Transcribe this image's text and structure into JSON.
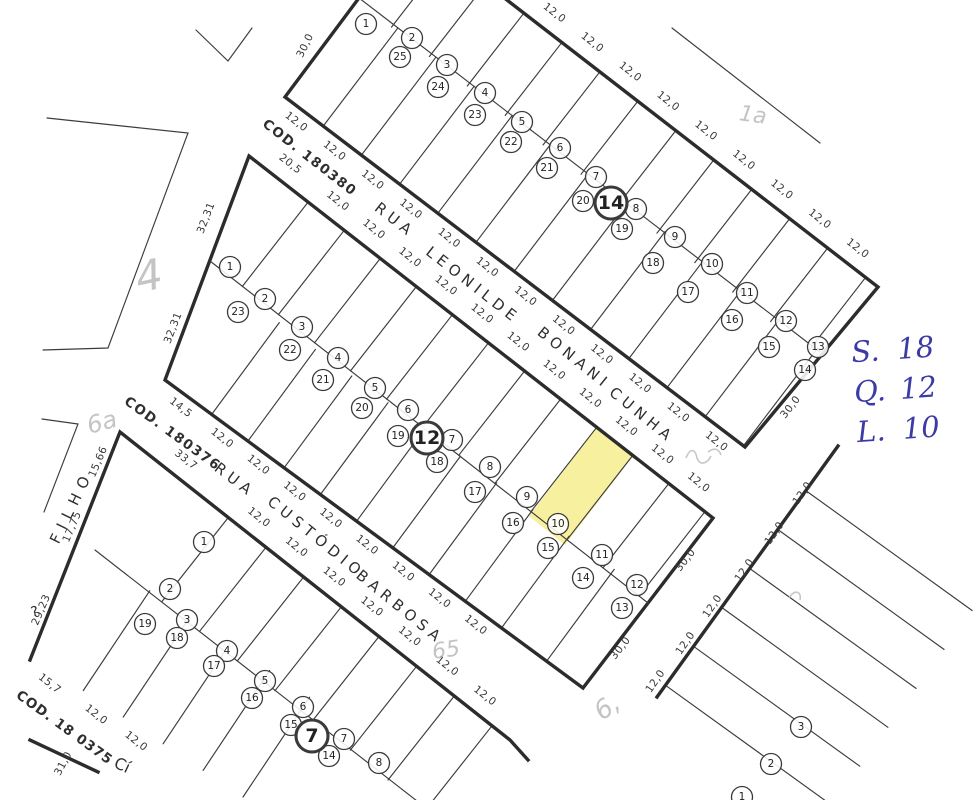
{
  "page": {
    "paper": "#ffffff",
    "ink": "#2c2c2c",
    "highlight_color": "#f6f09f",
    "pencil_color": "#b8b8b8",
    "handwriting_color": "#3c3aa5"
  },
  "annotation": {
    "lines": [
      {
        "label": "S.",
        "value": "18"
      },
      {
        "label": "Q.",
        "value": "12"
      },
      {
        "label": "L.",
        "value": "10"
      }
    ]
  },
  "highlight_info": {
    "quadra": "12",
    "lote": "10"
  },
  "map": {
    "highlight_lot": {
      "points": [
        [
          597,
          427
        ],
        [
          633,
          456
        ],
        [
          565,
          545
        ],
        [
          529,
          516
        ]
      ]
    },
    "rows": [
      {
        "id": "quadra14-front-leonilde",
        "edge": [
          285,
          97,
          745,
          447
        ],
        "side": 1,
        "depth": 123,
        "widths": [
          48,
          48,
          48,
          48,
          48,
          48,
          48,
          48,
          48,
          48,
          48,
          48
        ],
        "dims": [
          "12,0",
          "12,0",
          "12,0",
          "12,0",
          "12,0",
          "12,0",
          "12,0",
          "12,0",
          "12,0",
          "12,0",
          "12,0",
          "12,0"
        ],
        "dim_rot": 38
      },
      {
        "id": "quadra14-back-street",
        "edge": [
          410,
          -75,
          880,
          290
        ],
        "side": -1,
        "depth": 92,
        "widths": [
          48,
          48,
          48,
          48,
          48,
          48,
          48,
          48,
          48,
          48,
          48,
          48
        ],
        "dims": [
          "12,0",
          "12,0",
          "12,0",
          "12,0",
          "12,0",
          "12,0",
          "12,0",
          "12,0",
          "12,0",
          "12,0",
          "12,0",
          "12,0"
        ],
        "dim_rot": 38
      },
      {
        "id": "quadra12-front-leonilde",
        "edge": [
          249,
          156,
          713,
          518
        ],
        "side": -1,
        "depth": 107,
        "widths": [
          75,
          45.75,
          45.75,
          45.75,
          45.75,
          45.75,
          45.75,
          45.75,
          45.75,
          45.75,
          45.75,
          45.75,
          45.75
        ],
        "dims": [
          "20,5",
          "12,0",
          "12,0",
          "12,0",
          "12,0",
          "12,0",
          "12,0",
          "12,0",
          "12,0",
          "12,0",
          "12,0",
          "12,0",
          ""
        ],
        "dim_rot": 38
      },
      {
        "id": "quadra12-back-barbosa",
        "edge": [
          165,
          380,
          583,
          688
        ],
        "side": 1,
        "depth": 114,
        "widths": [
          58,
          45,
          45,
          45,
          45,
          45,
          45,
          45,
          45,
          56
        ],
        "dims": [
          "14,5",
          "12,0",
          "12,0",
          "12,0",
          "12,0",
          "12,0",
          "12,0",
          "12,0",
          "12,0",
          ""
        ],
        "dim_rot": 38
      },
      {
        "id": "quadra7-front-barbosa",
        "edge": [
          120,
          432,
          510,
          740
        ],
        "side": -1,
        "depth": 107,
        "widths": [
          138,
          48,
          48,
          48,
          48,
          48,
          48,
          48
        ],
        "dims": [
          "33,7",
          "12,0",
          "12,0",
          "12,0",
          "12,0",
          "12,0",
          "12,0",
          "12,0"
        ],
        "dim_rot": 38
      },
      {
        "id": "quadra7-back-street",
        "edge": [
          30,
          655,
          255,
          805
        ],
        "side": 1,
        "depth": 120,
        "hide_edge": true,
        "widths": [
          64,
          48,
          48,
          48,
          48,
          48
        ],
        "dims": [
          "15,7",
          "12,0",
          "12,0",
          "",
          "",
          ""
        ],
        "dim_rot": 38
      },
      {
        "id": "cross-street-block",
        "edge": [
          838,
          446,
          657,
          697
        ],
        "side": 1,
        "depth": 205,
        "widths": [
          55,
          48,
          48,
          48,
          48,
          48
        ],
        "dims": [],
        "dim_rot": -55
      }
    ],
    "outlines": [
      {
        "cls": "thick",
        "closed": true,
        "pts": "412,-73 285,97 745,447 878,287 410,-75"
      },
      {
        "cls": "thick",
        "closed": true,
        "pts": "249,156 713,518 583,688 165,380"
      },
      {
        "cls": "thick",
        "closed": false,
        "pts": "30,660 120,432 510,740 528,760"
      },
      {
        "cls": "thick",
        "closed": false,
        "pts": "838,446 657,697"
      },
      {
        "cls": "thick",
        "closed": false,
        "pts": "30,740 98,772"
      },
      {
        "cls": "thin",
        "closed": false,
        "pts": "359,-2 820,352"
      },
      {
        "cls": "thin",
        "closed": false,
        "pts": "210,261 648,603"
      },
      {
        "cls": "thin",
        "closed": false,
        "pts": "95,550 426,808"
      },
      {
        "cls": "thin",
        "closed": false,
        "pts": "672,28 820,143"
      },
      {
        "cls": "thin",
        "closed": false,
        "pts": "196,30 228,61 252,28"
      },
      {
        "cls": "thin",
        "closed": false,
        "pts": "47,118 188,133 108,348 43,350"
      },
      {
        "cls": "thin",
        "closed": false,
        "pts": "42,419 78,424 44,512"
      }
    ],
    "labels": [
      {
        "t": "30,0",
        "x": 308,
        "y": 47,
        "rot": -64
      },
      {
        "t": "30,0",
        "x": 793,
        "y": 409,
        "rot": -52
      },
      {
        "t": "30,0",
        "x": 688,
        "y": 562,
        "rot": -52
      },
      {
        "t": "30,0",
        "x": 623,
        "y": 650,
        "rot": -52
      },
      {
        "t": "32,31",
        "x": 209,
        "y": 219,
        "rot": -69
      },
      {
        "t": "32,31",
        "x": 176,
        "y": 329,
        "rot": -69
      },
      {
        "t": "15,66",
        "x": 101,
        "y": 463,
        "rot": -67
      },
      {
        "t": "17,75",
        "x": 75,
        "y": 528,
        "rot": -67
      },
      {
        "t": "29,23",
        "x": 44,
        "y": 611,
        "rot": -67
      },
      {
        "t": "31,0",
        "x": 66,
        "y": 765,
        "rot": -62
      },
      {
        "t": "12,0",
        "x": 805,
        "y": 495,
        "rot": -55
      },
      {
        "t": "12,0",
        "x": 777,
        "y": 535,
        "rot": -55
      },
      {
        "t": "12,0",
        "x": 747,
        "y": 572,
        "rot": -55
      },
      {
        "t": "12,0",
        "x": 715,
        "y": 608,
        "rot": -55
      },
      {
        "t": "12,0",
        "x": 688,
        "y": 645,
        "rot": -55
      },
      {
        "t": "12,0",
        "x": 658,
        "y": 683,
        "rot": -55
      }
    ],
    "street_labels": [
      {
        "t": "COD. 180380",
        "x": 307,
        "y": 161,
        "rot": 38,
        "size": 13.5,
        "ls": 1.5,
        "bold": true
      },
      {
        "t": "RUA",
        "x": 392,
        "y": 224,
        "rot": 38,
        "size": 15,
        "ls": 5
      },
      {
        "t": "LEONILDE",
        "x": 470,
        "y": 289,
        "rot": 38,
        "size": 15,
        "ls": 5
      },
      {
        "t": "BONANI",
        "x": 571,
        "y": 362,
        "rot": 39,
        "size": 15,
        "ls": 5
      },
      {
        "t": "CUNHA",
        "x": 639,
        "y": 419,
        "rot": 39,
        "size": 15,
        "ls": 5
      },
      {
        "t": "COD. 180376",
        "x": 170,
        "y": 437,
        "rot": 36,
        "size": 13.5,
        "ls": 1.5,
        "bold": true
      },
      {
        "t": "RUA",
        "x": 232,
        "y": 484,
        "rot": 37,
        "size": 15,
        "ls": 5
      },
      {
        "t": "CUSTÓDIO",
        "x": 313,
        "y": 541,
        "rot": 39,
        "size": 15,
        "ls": 5
      },
      {
        "t": "BARBOSA",
        "x": 397,
        "y": 611,
        "rot": 39,
        "size": 15,
        "ls": 5
      },
      {
        "t": "FILHO",
        "x": 76,
        "y": 509,
        "rot": -64,
        "size": 15,
        "ls": 7
      },
      {
        "t": "COD. 18 0375",
        "x": 62,
        "y": 731,
        "rot": 36,
        "size": 13.5,
        "ls": 1,
        "bold": true
      },
      {
        "t": "Cí",
        "x": 120,
        "y": 770,
        "rot": 25,
        "size": 16
      },
      {
        "t": "?",
        "x": 36,
        "y": 616,
        "rot": -15,
        "size": 14
      }
    ],
    "circles": [
      {
        "n": "1",
        "x": 366,
        "y": 24
      },
      {
        "n": "2",
        "x": 412,
        "y": 38
      },
      {
        "n": "3",
        "x": 447,
        "y": 65
      },
      {
        "n": "4",
        "x": 485,
        "y": 93
      },
      {
        "n": "5",
        "x": 522,
        "y": 122
      },
      {
        "n": "6",
        "x": 560,
        "y": 148
      },
      {
        "n": "7",
        "x": 596,
        "y": 177
      },
      {
        "n": "8",
        "x": 636,
        "y": 209
      },
      {
        "n": "9",
        "x": 675,
        "y": 237
      },
      {
        "n": "10",
        "x": 712,
        "y": 264
      },
      {
        "n": "11",
        "x": 747,
        "y": 293
      },
      {
        "n": "12",
        "x": 786,
        "y": 321
      },
      {
        "n": "13",
        "x": 818,
        "y": 347
      },
      {
        "n": "25",
        "x": 400,
        "y": 57
      },
      {
        "n": "24",
        "x": 438,
        "y": 87
      },
      {
        "n": "23",
        "x": 475,
        "y": 115
      },
      {
        "n": "22",
        "x": 511,
        "y": 142
      },
      {
        "n": "21",
        "x": 547,
        "y": 168
      },
      {
        "n": "20",
        "x": 583,
        "y": 201
      },
      {
        "n": "19",
        "x": 622,
        "y": 229
      },
      {
        "n": "18",
        "x": 653,
        "y": 263
      },
      {
        "n": "17",
        "x": 688,
        "y": 292
      },
      {
        "n": "16",
        "x": 732,
        "y": 320
      },
      {
        "n": "15",
        "x": 769,
        "y": 347
      },
      {
        "n": "14",
        "x": 805,
        "y": 370
      },
      {
        "n": "14",
        "x": 611,
        "y": 203,
        "big": true
      },
      {
        "n": "1",
        "x": 230,
        "y": 267
      },
      {
        "n": "2",
        "x": 265,
        "y": 299
      },
      {
        "n": "3",
        "x": 302,
        "y": 327
      },
      {
        "n": "4",
        "x": 338,
        "y": 358
      },
      {
        "n": "5",
        "x": 375,
        "y": 388
      },
      {
        "n": "6",
        "x": 408,
        "y": 410
      },
      {
        "n": "7",
        "x": 452,
        "y": 440
      },
      {
        "n": "8",
        "x": 490,
        "y": 467
      },
      {
        "n": "9",
        "x": 527,
        "y": 497
      },
      {
        "n": "10",
        "x": 558,
        "y": 524
      },
      {
        "n": "11",
        "x": 602,
        "y": 555
      },
      {
        "n": "12",
        "x": 637,
        "y": 585
      },
      {
        "n": "13",
        "x": 622,
        "y": 608
      },
      {
        "n": "23",
        "x": 238,
        "y": 312
      },
      {
        "n": "22",
        "x": 290,
        "y": 350
      },
      {
        "n": "21",
        "x": 323,
        "y": 380
      },
      {
        "n": "20",
        "x": 362,
        "y": 408
      },
      {
        "n": "19",
        "x": 398,
        "y": 436
      },
      {
        "n": "18",
        "x": 437,
        "y": 462
      },
      {
        "n": "17",
        "x": 475,
        "y": 492
      },
      {
        "n": "16",
        "x": 513,
        "y": 523
      },
      {
        "n": "15",
        "x": 548,
        "y": 548
      },
      {
        "n": "14",
        "x": 583,
        "y": 578
      },
      {
        "n": "12",
        "x": 427,
        "y": 438,
        "big": true
      },
      {
        "n": "1",
        "x": 204,
        "y": 542
      },
      {
        "n": "2",
        "x": 170,
        "y": 589
      },
      {
        "n": "3",
        "x": 187,
        "y": 620
      },
      {
        "n": "4",
        "x": 227,
        "y": 651
      },
      {
        "n": "5",
        "x": 265,
        "y": 681
      },
      {
        "n": "6",
        "x": 303,
        "y": 707
      },
      {
        "n": "7",
        "x": 344,
        "y": 739
      },
      {
        "n": "8",
        "x": 379,
        "y": 763
      },
      {
        "n": "19",
        "x": 145,
        "y": 624
      },
      {
        "n": "18",
        "x": 177,
        "y": 638
      },
      {
        "n": "17",
        "x": 214,
        "y": 666
      },
      {
        "n": "16",
        "x": 252,
        "y": 698
      },
      {
        "n": "15",
        "x": 291,
        "y": 725
      },
      {
        "n": "14",
        "x": 329,
        "y": 756
      },
      {
        "n": "7",
        "x": 312,
        "y": 736,
        "big": true
      },
      {
        "n": "3",
        "x": 801,
        "y": 727
      },
      {
        "n": "2",
        "x": 771,
        "y": 764
      },
      {
        "n": "1",
        "x": 742,
        "y": 797
      }
    ],
    "pencil_texts": [
      {
        "t": "4",
        "x": 152,
        "y": 290,
        "rot": -12,
        "size": 42
      },
      {
        "t": "6a",
        "x": 104,
        "y": 430,
        "rot": -15,
        "size": 24
      },
      {
        "t": "1a",
        "x": 752,
        "y": 122,
        "rot": 8,
        "size": 22
      },
      {
        "t": "65",
        "x": 447,
        "y": 657,
        "rot": -8,
        "size": 22
      },
      {
        "t": "6,",
        "x": 612,
        "y": 714,
        "rot": -35,
        "size": 26
      }
    ],
    "pencil_paths": [
      "M686,458 c4,-10 9,-10 11,0 c3,8 10,6 14,-2",
      "M708,452 c6,-5 11,-3 13,3",
      "M789,598 c5,-9 13,-7 11,2"
    ]
  }
}
